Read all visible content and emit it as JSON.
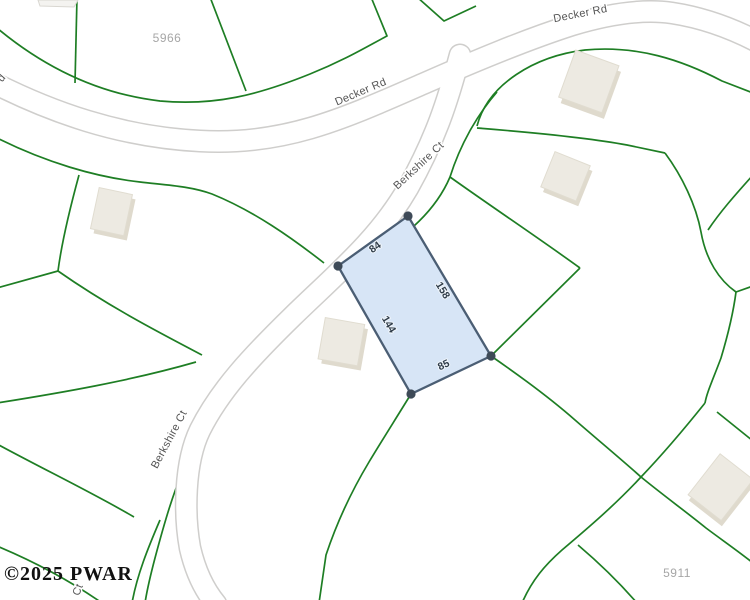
{
  "map": {
    "watermark": {
      "text": "©2025 PWAR"
    },
    "road_labels": [
      {
        "id": "decker-rd-top",
        "text": "Decker Rd"
      },
      {
        "id": "decker-rd-left",
        "text": "Decker Rd"
      },
      {
        "id": "berkshire-ct-upper",
        "text": "Berkshire Ct"
      },
      {
        "id": "berkshire-ct-lower",
        "text": "Berkshire Ct"
      },
      {
        "id": "ct-fragment",
        "text": "Ct"
      },
      {
        "id": "d-fragment",
        "text": "d"
      }
    ],
    "parcel_numbers": [
      {
        "id": "parcel-5966",
        "text": "5966"
      },
      {
        "id": "parcel-5911",
        "text": "5911"
      }
    ],
    "highlighted_parcel": {
      "dimensions": [
        {
          "side": "top",
          "text": "84"
        },
        {
          "side": "right",
          "text": "158"
        },
        {
          "side": "left",
          "text": "144"
        },
        {
          "side": "bottom",
          "text": "85"
        }
      ],
      "fill": "#d7e5f6",
      "stroke": "#4b5e74",
      "node_color": "#3e4a57"
    },
    "colors": {
      "parcel_line": "#1e7e24",
      "road_fill": "#ffffff",
      "road_casing": "#cfcecc",
      "road_label": "#545454",
      "parcel_number": "#a6a6a6",
      "building_fill": "#edeae2",
      "building_shade": "#dfdacd",
      "watermark_color": "#111111",
      "background": "#ffffff"
    }
  }
}
